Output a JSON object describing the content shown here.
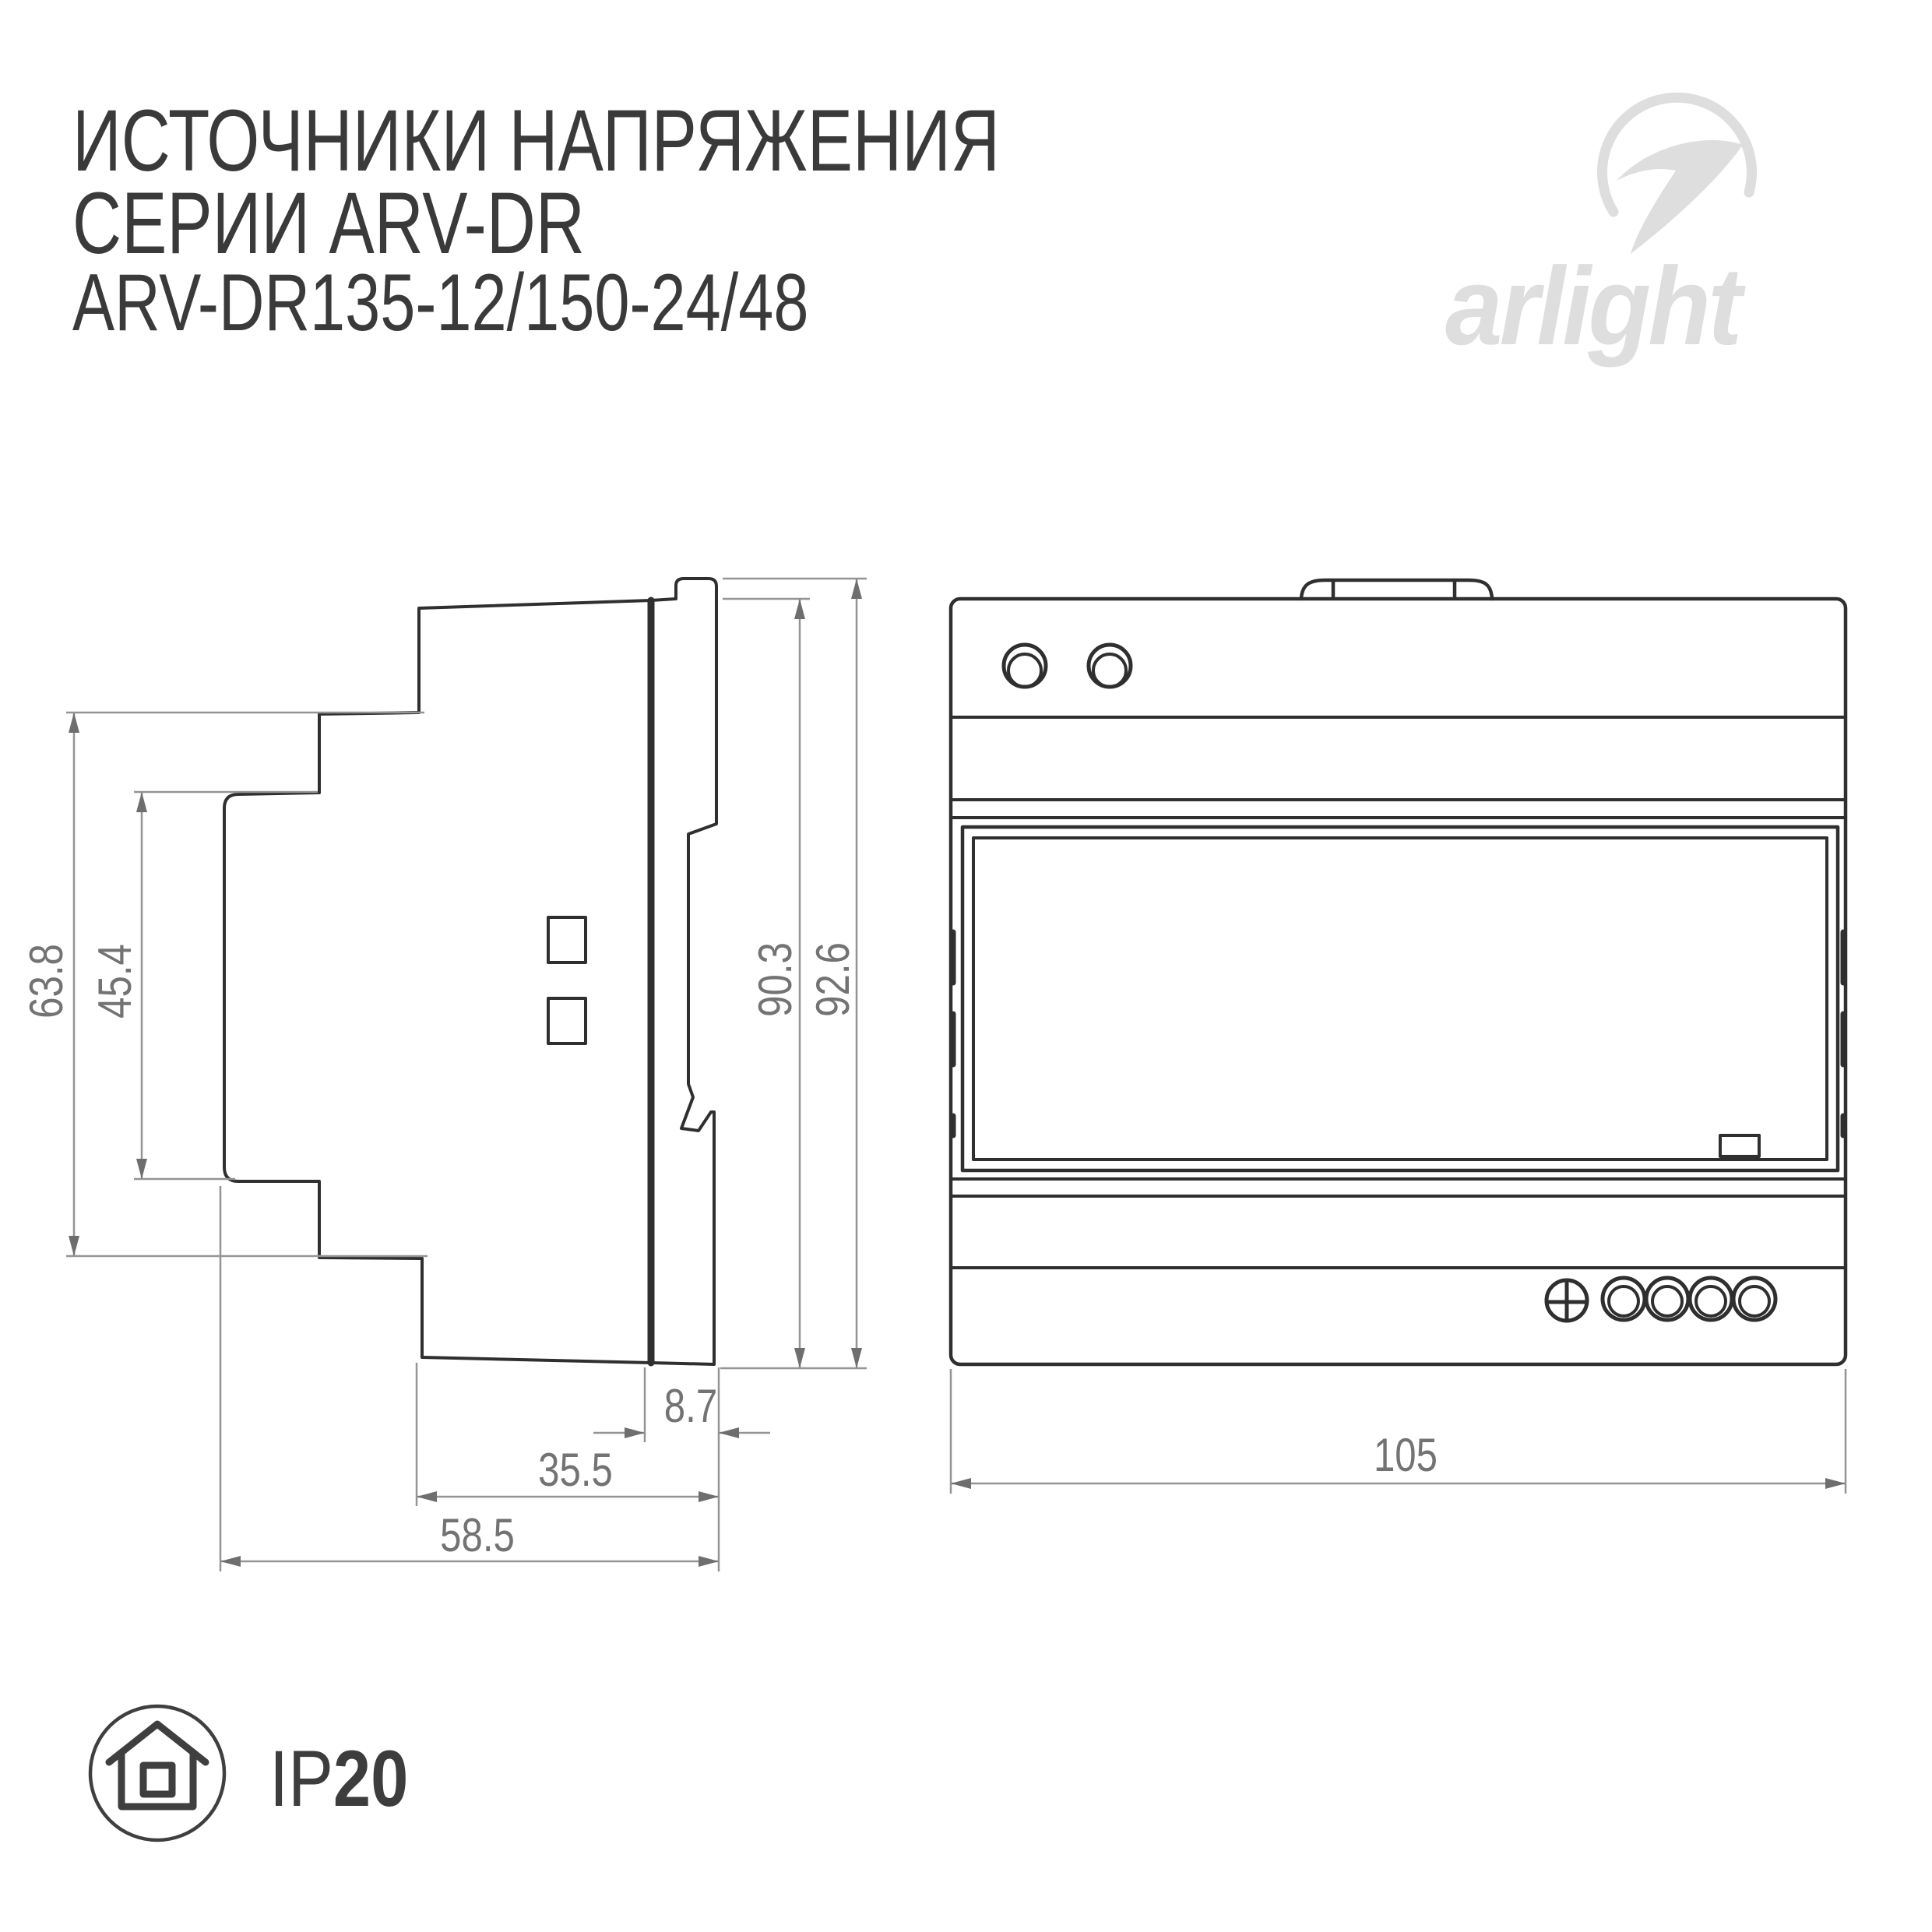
{
  "header": {
    "title_line1": "ИСТОЧНИКИ НАПРЯЖЕНИЯ",
    "title_line2": "СЕРИИ ARV-DR",
    "title_line3": "ARV-DR135-12/150-24/48"
  },
  "logo": {
    "brand": "arlight"
  },
  "diagram": {
    "side_view": {
      "dim_height_front": "63.8",
      "dim_height_recess": "45.4",
      "dim_height_body": "90.3",
      "dim_height_total": "92.6",
      "dim_clip_depth": "8.7",
      "dim_body_depth": "35.5",
      "dim_total_depth": "58.5"
    },
    "front_view": {
      "dim_width": "105"
    }
  },
  "footer": {
    "ip_prefix": "IP",
    "ip_rating": "20"
  },
  "colors": {
    "drawing_line": "#2f2f2f",
    "dimension_line": "#949494",
    "dimension_text": "#737373",
    "title_text": "#3a3a3a",
    "logo_gray": "#dedede"
  }
}
